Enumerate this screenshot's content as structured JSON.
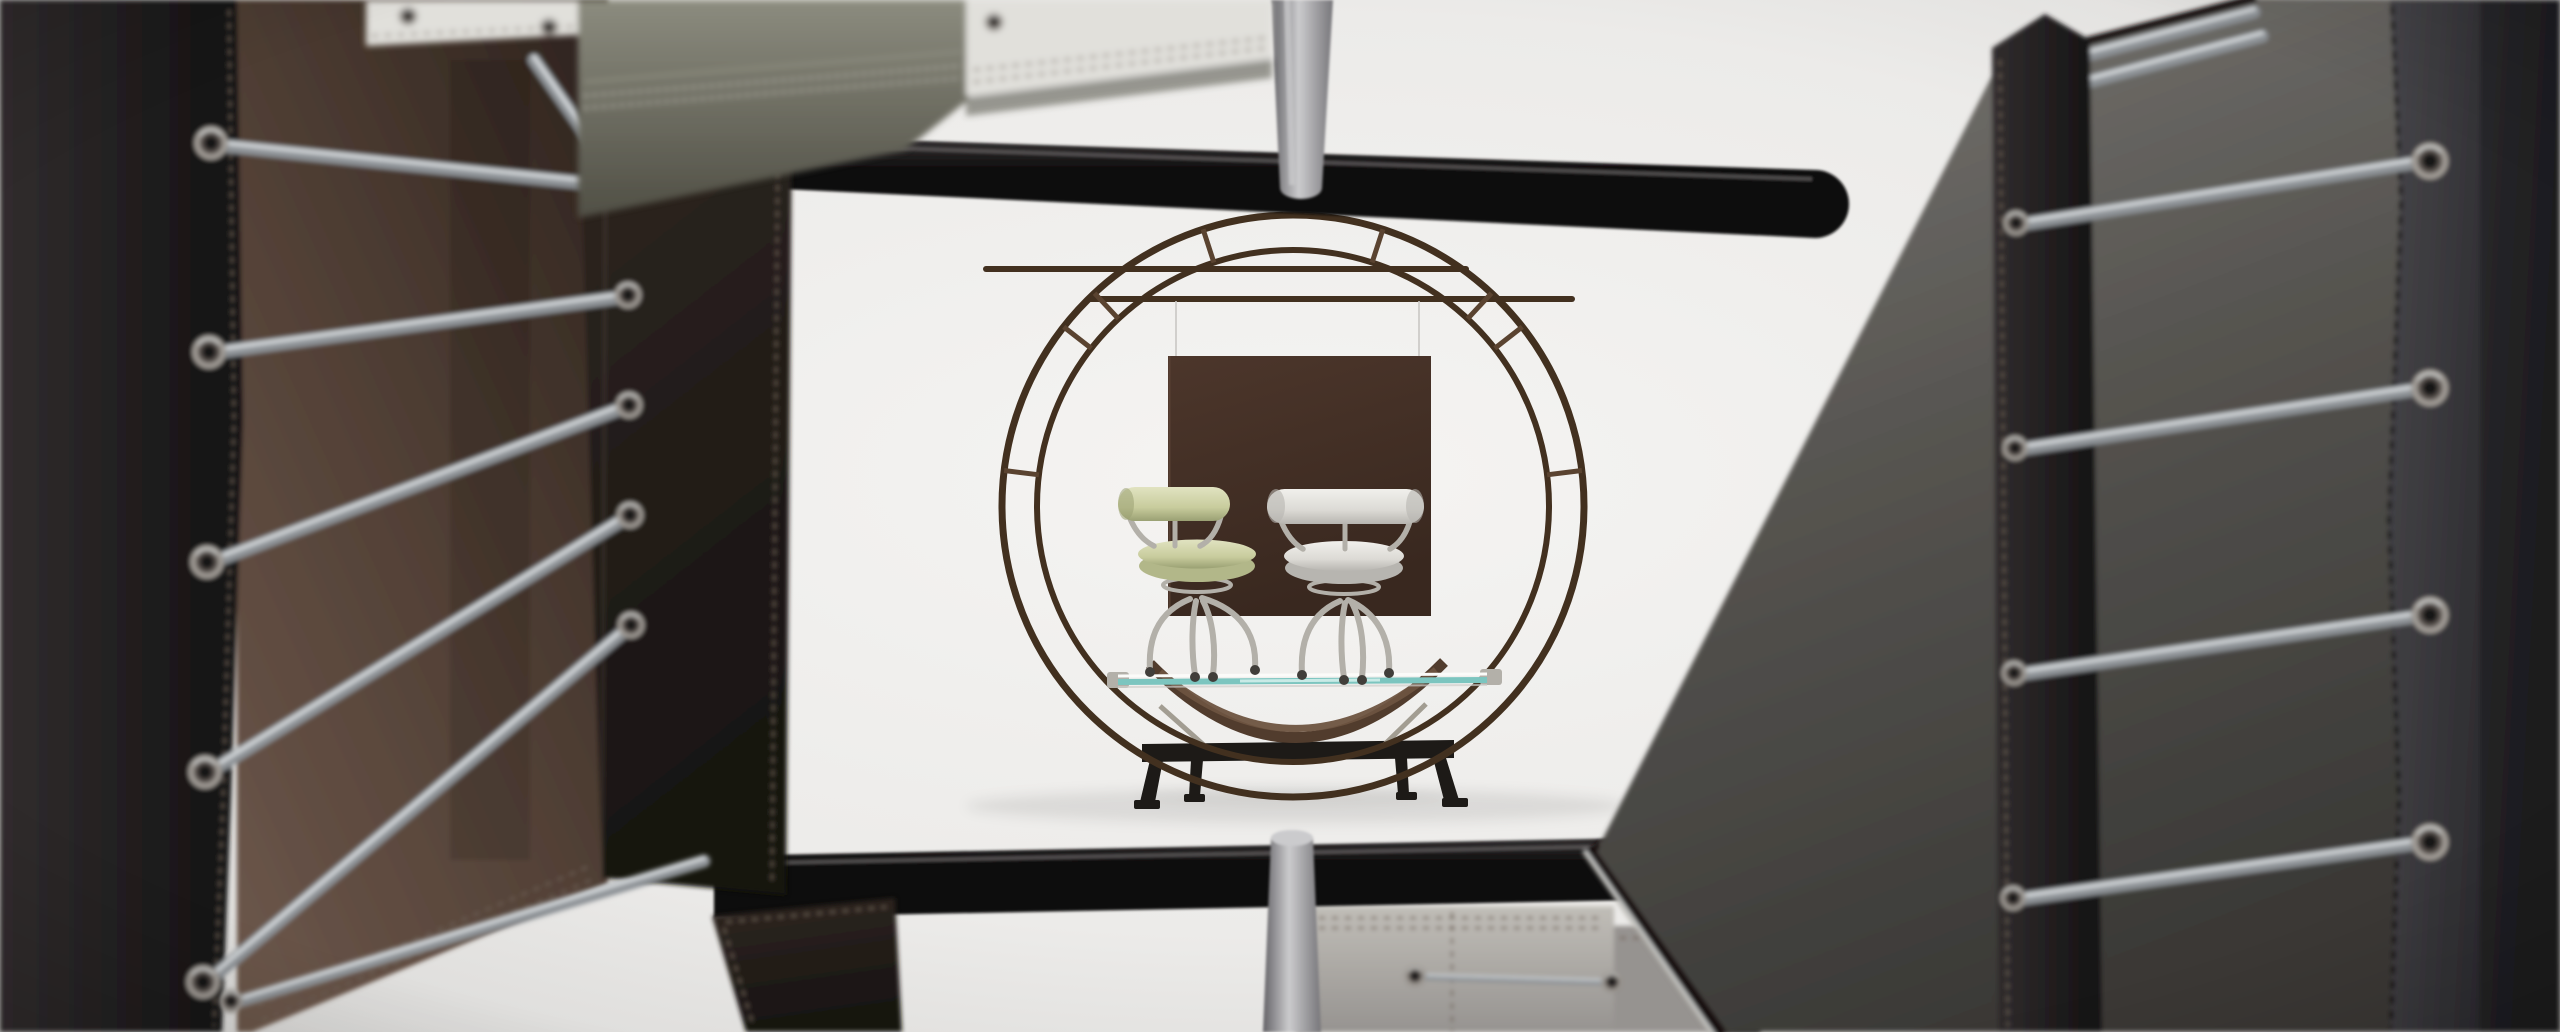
{
  "meta": {
    "type": "photograph",
    "title": "studio-still-life-of-tubular-leather-chairs",
    "description": "View through a square arrangement of out-of-focus black and brown leather chair backs laced with steel extension springs, framing a white studio set. In the center a dark tubular double-circle display frame on a black trestle base holds a glass shelf with two small swivel chairs (one pale green, one white) in front of a hanging dark-brown square panel. Black tubular cross bars and tapered silver legs cross the top and bottom foreground.",
    "visible_text": []
  },
  "palette": {
    "backdrop-light": "#f5f4f2",
    "backdrop-mid": "#ecebe9",
    "backdrop-dark": "#d7d6d4",
    "black-leather-1": "#312d2e",
    "black-leather-2": "#131112",
    "suede-light": "#6b564a",
    "suede-mid": "#4e3d33",
    "suede-dark": "#30251f",
    "dark-leather-1": "#2f2722",
    "dark-leather-2": "#171310",
    "grey-suede-1": "#7a7874",
    "grey-suede-2": "#55534f",
    "grey-suede-3": "#3a3936",
    "grey-leather-1": "#47464a",
    "grey-leather-2": "#232226",
    "chrome-dark": "#8d9296",
    "chrome-mid": "#b3b0a9",
    "chrome-light": "#dde1e3",
    "steel-ring": "#a39e98",
    "steel-dark": "#57504b",
    "steel-hole": "#191614",
    "frame-brown": "#42301f",
    "frame-brown-2": "#5a4330",
    "bar-1": "#3a3738",
    "bar-2": "#0c0b0b",
    "bar-hi": "#5c5859",
    "tube-1": "#77767a",
    "tube-2": "#cbcbcd",
    "tube-3": "#636266",
    "panel-brown-1": "#4c362b",
    "panel-brown-2": "#39281f",
    "strap-1": "#513c2d",
    "strap-2": "#6d5340",
    "glass-teal": "#7cc5bf",
    "glass-teal-light": "#d2efeb",
    "chair-green-1": "#e1e3c1",
    "chair-green-2": "#c8cc9d",
    "chair-green-3": "#9aa073",
    "chair-white-1": "#f1f0ec",
    "chair-white-2": "#dcdad5",
    "chair-white-3": "#b7b5b0",
    "trestle": "#1d1a17",
    "sage-1": "#8c8c7f",
    "sage-2": "#504f45",
    "white-leather": "#e1e0db",
    "grey-panel-1": "#c1beb8",
    "grey-panel-2": "#969390",
    "stitch-light": "#c2c0b6",
    "stitch-dark": "#6e6257",
    "shadow": "#000000"
  },
  "scene": {
    "background": "white studio cyclorama",
    "center": [
      "double-circle display frame",
      "hanging brown square panel",
      "green swivel chair",
      "white swivel chair",
      "glass shelf",
      "black trestle base",
      "leather sling straps"
    ],
    "foreground": [
      "black tubular cross bar top",
      "black tubular cross bar bottom",
      "tapered silver leg top",
      "tapered silver leg bottom",
      "black leather back panels",
      "brown suede interior",
      "grey suede interior",
      "steel extension springs",
      "metal eyelets",
      "stitched grey leather panels"
    ],
    "counts": {
      "left_springs": 7,
      "right_springs": 6,
      "left_eyelets": 11,
      "right_eyelets": 9,
      "circle_struts": 8,
      "chairs": 2
    }
  }
}
